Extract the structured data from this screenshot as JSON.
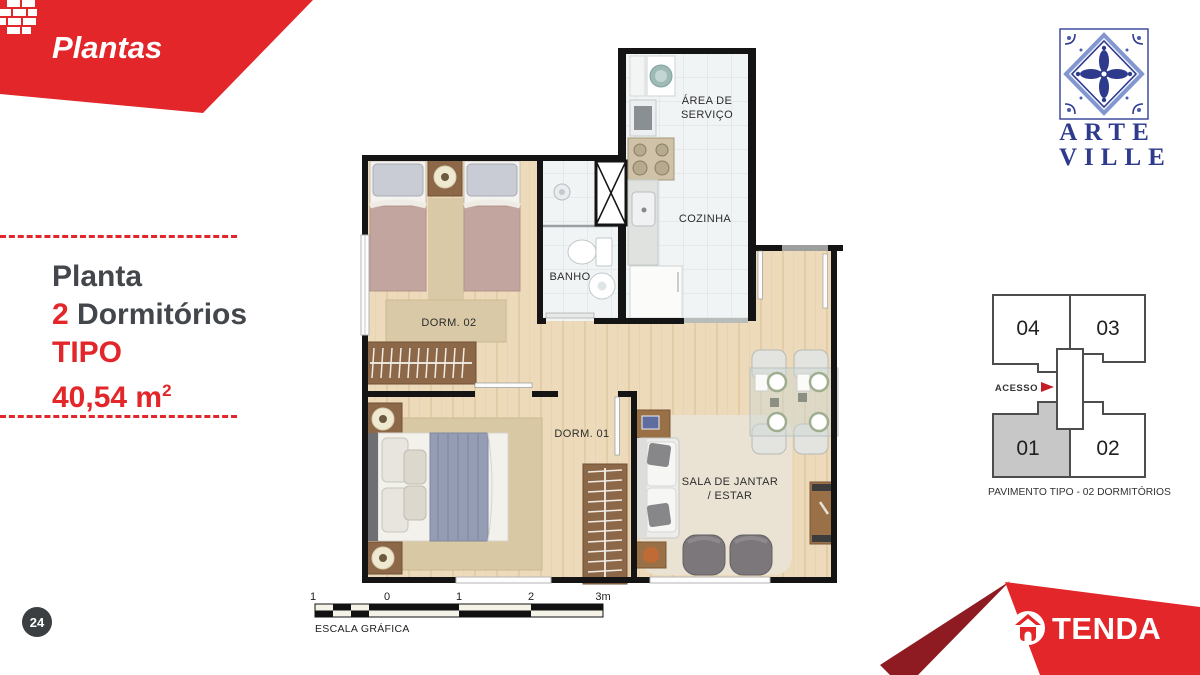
{
  "banner": {
    "title": "Plantas"
  },
  "info": {
    "line1": "Planta",
    "line2_num": "2",
    "line2_text": "Dormitórios",
    "line3": "TIPO",
    "area_value": "40,54 m",
    "area_sup": "2"
  },
  "logo": {
    "line1": "ARTE",
    "line2": "VILLE"
  },
  "plan": {
    "rooms": {
      "servico_l1": "ÁREA DE",
      "servico_l2": "SERVIÇO",
      "cozinha": "COZINHA",
      "banho": "BANHO",
      "dorm02": "DORM. 02",
      "dorm01": "DORM. 01",
      "sala_l1": "SALA DE JANTAR",
      "sala_l2": "/ ESTAR"
    }
  },
  "scalebar": {
    "ticks": [
      "1",
      "0",
      "1",
      "2",
      "3m"
    ],
    "caption": "ESCALA GRÁFICA"
  },
  "keyplan": {
    "units": [
      "04",
      "03",
      "01",
      "02"
    ],
    "access_label": "ACESSO",
    "caption": "PAVIMENTO TIPO - 02 DORMITÓRIOS"
  },
  "footer": {
    "brand": "TENDA",
    "page_number": "24"
  },
  "colors": {
    "brand_red": "#e22629",
    "brand_dark_red": "#8e1b21",
    "logo_navy": "#2e3a8c",
    "highlight_unit_fill": "#c7c7c7",
    "wall_black": "#141414"
  }
}
